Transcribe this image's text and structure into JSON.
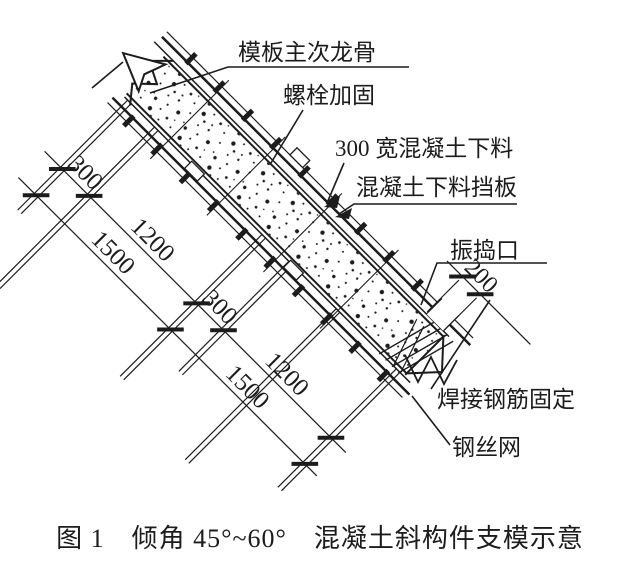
{
  "annotations": {
    "keel": "模板主次龙骨",
    "bolt": "螺栓加固",
    "chute": "300 宽混凝土下料",
    "baffle": "混凝土下料挡板",
    "vibration": "振捣口",
    "weld": "焊接钢筋固定",
    "mesh": "钢丝网"
  },
  "dimensions": {
    "bay1_300": "300",
    "bay1_1200": "1200",
    "bay1_1500": "1500",
    "bay2_300": "300",
    "bay2_1500": "1500",
    "bay2_1200": "1200",
    "port_200": "200"
  },
  "caption": "图 1　倾角 45°~60°　混凝土斜构件支模示意",
  "colors": {
    "ink": "#1c1c1c",
    "background": "#ffffff"
  }
}
